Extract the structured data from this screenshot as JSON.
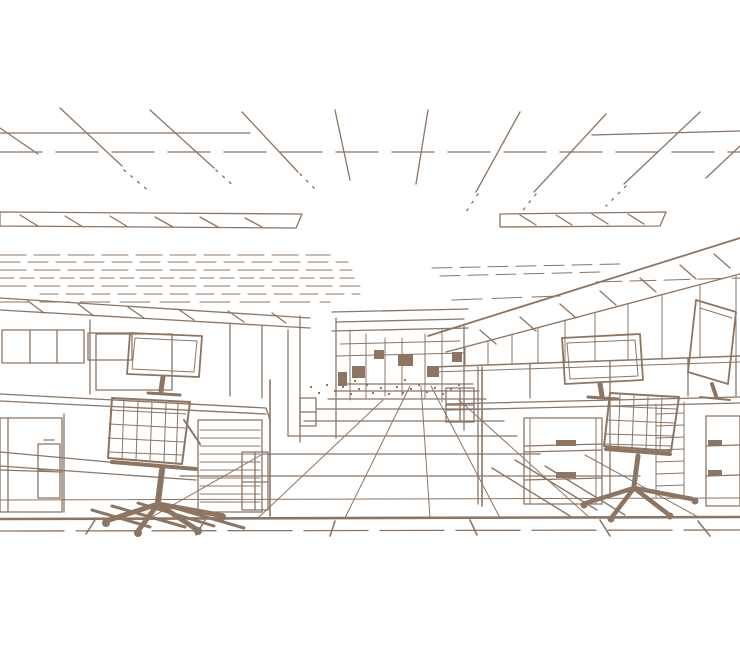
{
  "scene": {
    "description": "Sepia monochrome line-art sketch of an open-plan office interior drawn in one-point perspective: a central tiled corridor recedes to a vanishing point between two banks of cubicle workstations, each with a flat-panel monitor, a mesh-back swivel task chair on casters and file pedestals, beneath a suspended-grid ceiling with recessed light strips.",
    "style": "monochrome line drawing",
    "perspective": "one-point",
    "palette": {
      "line": "#8c7563",
      "background": "#ffffff"
    }
  },
  "elements": {
    "ceiling": "suspended ceiling tile grid with two recessed light strips and compressed far rows",
    "corridor": "central aisle of square floor tiles receding toward distant cubicle partitions",
    "left_workstation": {
      "monitor": "flat-panel monitor on desk",
      "chair": "mesh-back swivel chair with five-star caster base",
      "storage": "overhead bins, side cabinet and shelf pedestal"
    },
    "right_workstation": {
      "monitor": "flat-panel monitor on desk",
      "second_monitor": "rear view of monitor at far right desk",
      "chair": "mesh-back swivel chair with five-star caster base",
      "storage": "two drawer pedestals with pulls"
    },
    "background": "clerestory glass band and distant partition panels"
  }
}
